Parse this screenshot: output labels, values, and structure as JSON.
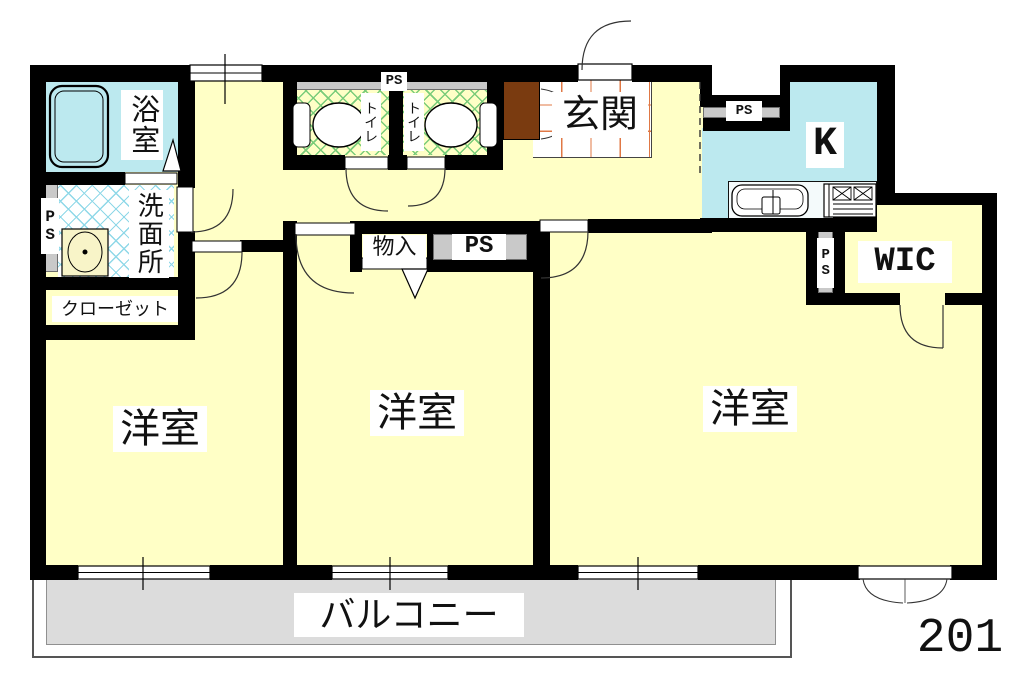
{
  "unit_number": "201",
  "labels": {
    "bath": "浴室",
    "washroom": "洗面所",
    "closet": "クローゼット",
    "toilet1": "トイレ",
    "toilet2": "トイレ",
    "entrance": "玄関",
    "kitchen": "K",
    "wic": "WIC",
    "storage": "物入",
    "western_room_left": "洋室",
    "western_room_center": "洋室",
    "western_room_right": "洋室",
    "balcony": "バルコニー",
    "ps_left": "PS",
    "ps_above_toilets": "PS",
    "ps_hall": "PS",
    "ps_kitchen": "PS",
    "ps_right": "PS"
  },
  "colors": {
    "room_floor": "#FFFFC6",
    "wet_area_floor": "#BCE9EF",
    "balcony_floor": "#DCDCDC",
    "service_shaft": "#C9C9C9",
    "wall": "#000000",
    "shoe_cabinet": "#7A3B10",
    "entrance_tile_grid": "#E07845",
    "toilet_lattice": "#7ACC7A",
    "washroom_lattice": "#8FD8E8"
  }
}
